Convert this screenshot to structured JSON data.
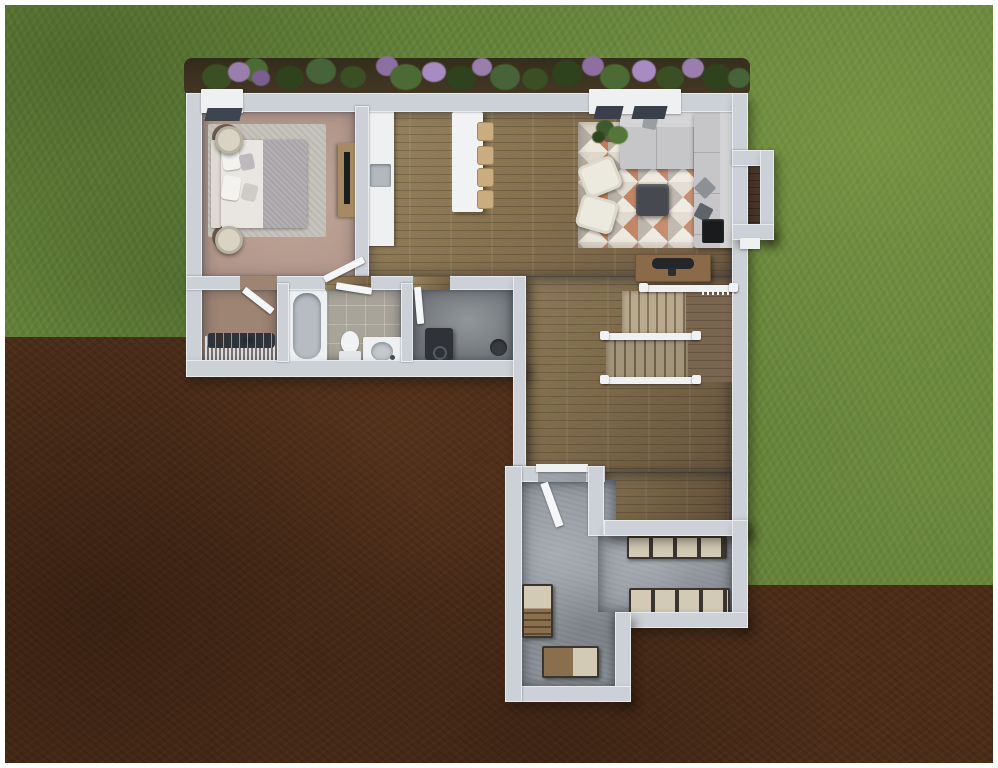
{
  "scene": {
    "type": "3d-floor-plan-rendering",
    "description": "Top-down 3D rendered floor plan of a single-story home footprint on a lot, grass upper area and exposed dirt lower-left and lower-right",
    "text_visible": "none",
    "palette": {
      "grass": "#64813a",
      "grass_highlight": "#8aa554",
      "dirt": "#4b2d1a",
      "wall": "#ccd1d8",
      "trim_white": "#f4f6f8",
      "wood_floor": "#86714f",
      "bedroom_carpet": "#b2978a",
      "closet_carpet": "#9e8472",
      "bath_tile": "#a9a49a",
      "mudroom_floor": "#73777b",
      "concrete": "#8e949a",
      "sofa_gray": "#c6c6c8",
      "rug_base": "#d9d2c5",
      "rug_orange": "#c2673c",
      "rug_gray": "#b2aca2",
      "island_white": "#f0f2f4",
      "stool_tan": "#c9ad80",
      "stair_tread": "#b9aa8e",
      "shelf_top": "#d3cab6",
      "shelf_frame": "#36332f",
      "bush_green": "#3e5527",
      "flower_purple": "#9a7fae"
    },
    "rooms": [
      {
        "name": "bedroom",
        "furniture": [
          "bed",
          "nightstand-lamp",
          "nightstand-lamp",
          "area-rug",
          "tv-console",
          "window"
        ]
      },
      {
        "name": "walk-in-closet",
        "furniture": [
          "clothes-rack"
        ]
      },
      {
        "name": "bathroom",
        "furniture": [
          "bathtub",
          "toilet",
          "vanity-sink"
        ]
      },
      {
        "name": "mudroom-utility",
        "furniture": [
          "utility-box",
          "floor-drain"
        ]
      },
      {
        "name": "kitchen-dining",
        "furniture": [
          "counter-with-sink",
          "island",
          "bar-stool",
          "bar-stool",
          "bar-stool",
          "bar-stool"
        ]
      },
      {
        "name": "living-room",
        "furniture": [
          "sectional-sofa",
          "area-rug",
          "ottoman",
          "armchair",
          "armchair",
          "plant",
          "fireplace",
          "console-table",
          "double-window",
          "bump-out-nook"
        ]
      },
      {
        "name": "staircase",
        "furniture": [
          "upper-flight",
          "lower-flight",
          "landing",
          "railings"
        ]
      },
      {
        "name": "garage-basement",
        "furniture": [
          "storage-shelf",
          "storage-shelf",
          "utility-unit",
          "workbench",
          "door"
        ]
      }
    ],
    "landscaping": [
      "flower-bed-with-purple-blooms",
      "shrubs"
    ]
  }
}
